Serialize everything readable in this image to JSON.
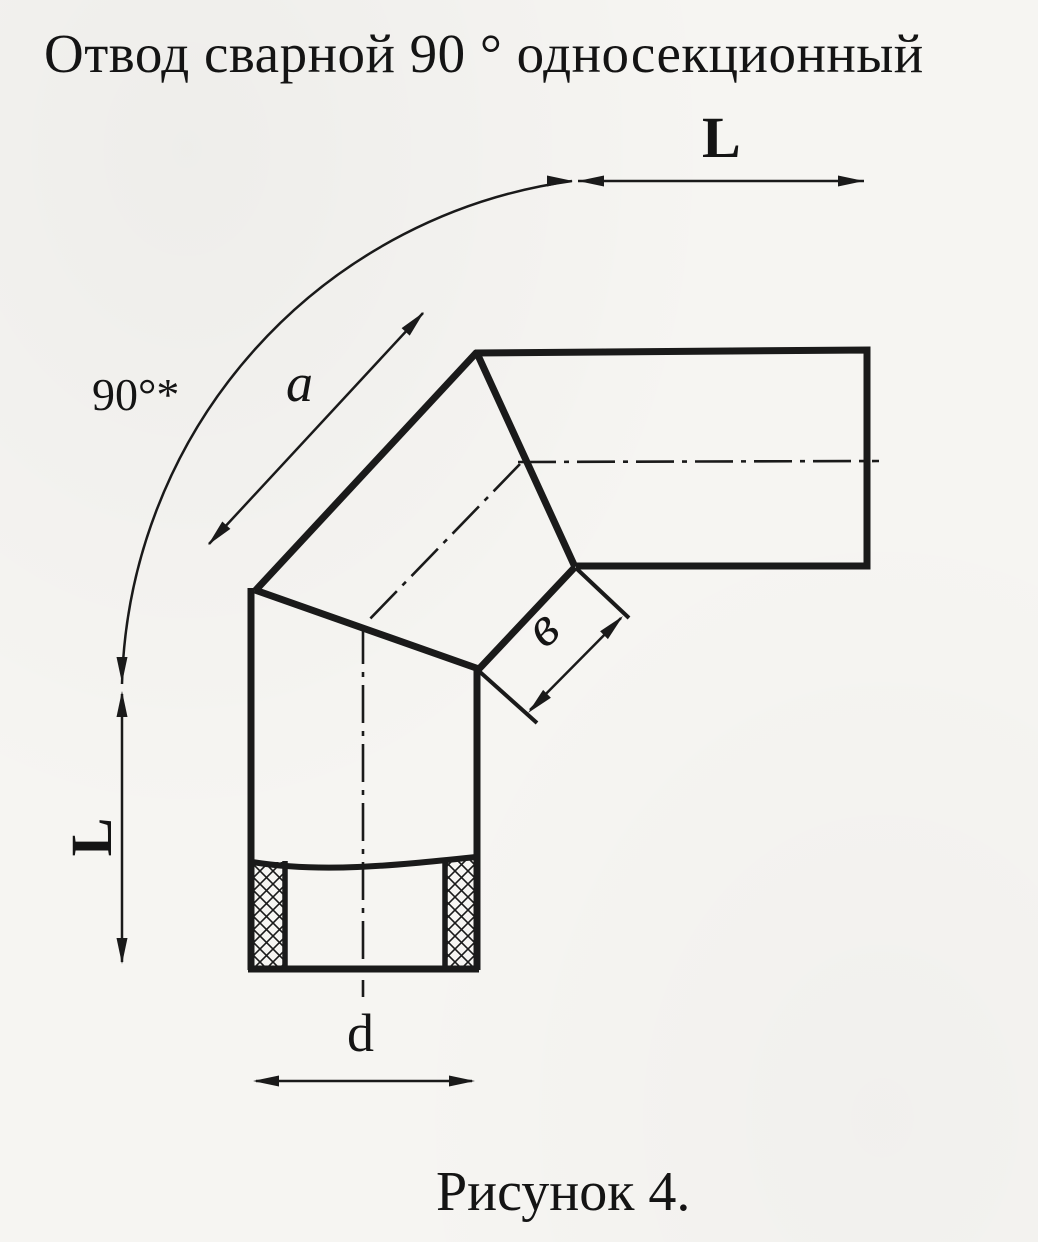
{
  "page": {
    "paper_color": "#f6f5f2",
    "ink_color": "#1a1a1a"
  },
  "title": "Отвод сварной 90 ° односекционный",
  "figure_caption": "Рисунок 4.",
  "dimensions": {
    "angle_label": "90°*",
    "top_length_label": "L",
    "left_length_label": "L",
    "outer_section_label": "a",
    "inner_section_label": "в",
    "diameter_label": "d"
  }
}
